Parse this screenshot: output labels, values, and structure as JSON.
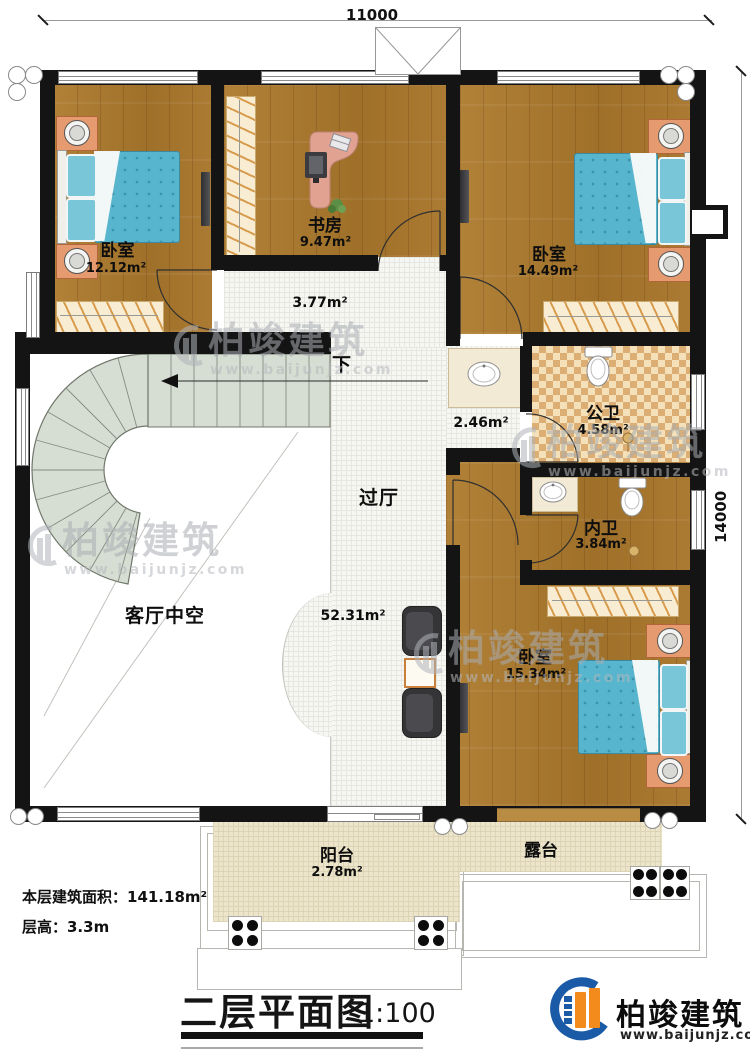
{
  "dims": {
    "width_mm": "11000",
    "height_mm": "14000"
  },
  "rooms": {
    "bedroom1": {
      "name": "卧室",
      "area": "12.12m²"
    },
    "study": {
      "name": "书房",
      "area": "9.47m²"
    },
    "upper_hall": {
      "area": "3.77m²"
    },
    "bedroom2": {
      "name": "卧室",
      "area": "14.49m²"
    },
    "bath_corridor": {
      "area": "2.46m²"
    },
    "public_bath": {
      "name": "公卫",
      "area": "4.58m²"
    },
    "private_bath": {
      "name": "内卫",
      "area": "3.84m²"
    },
    "bedroom3": {
      "name": "卧室",
      "area": "15.34m²"
    },
    "passage": {
      "name": "过厅",
      "area": "52.31m²"
    },
    "living_void": {
      "name": "客厅中空"
    },
    "balcony": {
      "name": "阳台",
      "area": "2.78m²"
    },
    "terrace": {
      "name": "露台"
    }
  },
  "stairs": {
    "direction_label": "下"
  },
  "notes": {
    "floor_area": "本层建筑面积：141.18m²",
    "floor_height": "层高：3.3m"
  },
  "title": {
    "text": "二层平面图",
    "scale": "1:100"
  },
  "brand": {
    "name": "柏竣建筑",
    "url": "www.baijunjz.com"
  },
  "watermark": {
    "name": "柏竣建筑",
    "url": "www.baijunjz.com"
  },
  "colors": {
    "wall": "#141414",
    "wood": "#a87c35",
    "bed": "#58b5ce",
    "bath_tile_light": "#f4e1ba",
    "bath_tile_dark": "#dcae74",
    "stair": "#d6ded3",
    "balcony_tile": "#ece5cb",
    "brand_blue": "#1a5aa6",
    "brand_orange": "#f28b1c"
  }
}
